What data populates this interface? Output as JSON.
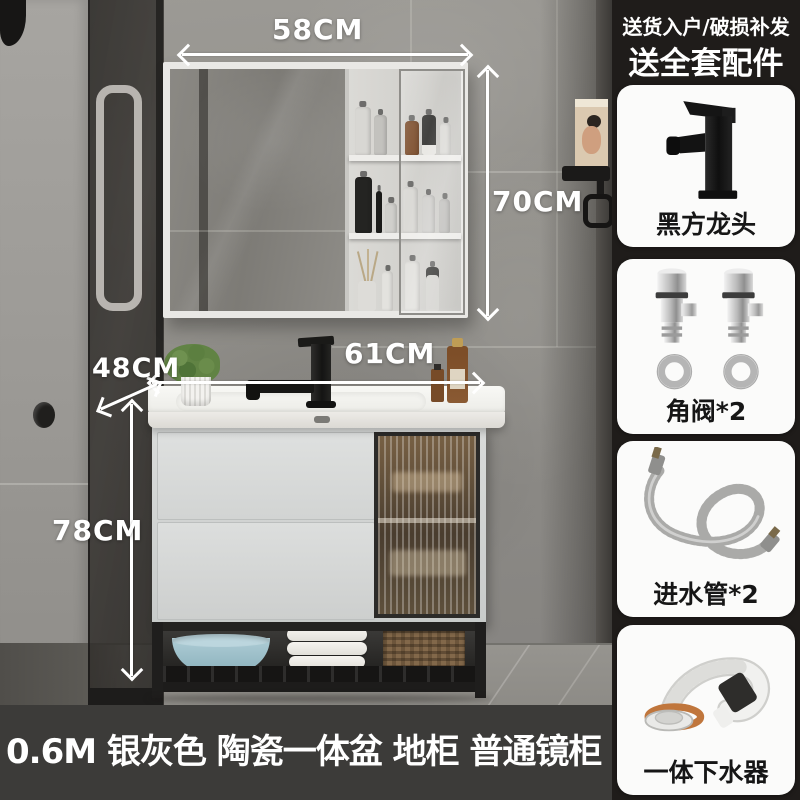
{
  "page": {
    "caption": "0.6M 银灰色 陶瓷一体盆 地柜 普通镜柜"
  },
  "dimensions": {
    "mirror_width": "58CM",
    "mirror_height": "70CM",
    "counter_width": "61CM",
    "counter_depth": "48CM",
    "cabinet_height": "78CM"
  },
  "sidebar": {
    "promo_line1": "送货入户/破损补发",
    "promo_line2": "送全套配件",
    "items": [
      {
        "icon": "black-faucet-icon",
        "label": "黑方龙头"
      },
      {
        "icon": "angle-valve-icon",
        "label": "角阀*2"
      },
      {
        "icon": "inlet-hose-icon",
        "label": "进水管*2"
      },
      {
        "icon": "drain-pipe-icon",
        "label": "一体下水器"
      }
    ]
  },
  "colors": {
    "caption_bar": "#3c3b39",
    "sidebar_bg": "#1f1c1a",
    "card_bg": "#fbfbfa",
    "annotation": "#ffffff"
  }
}
